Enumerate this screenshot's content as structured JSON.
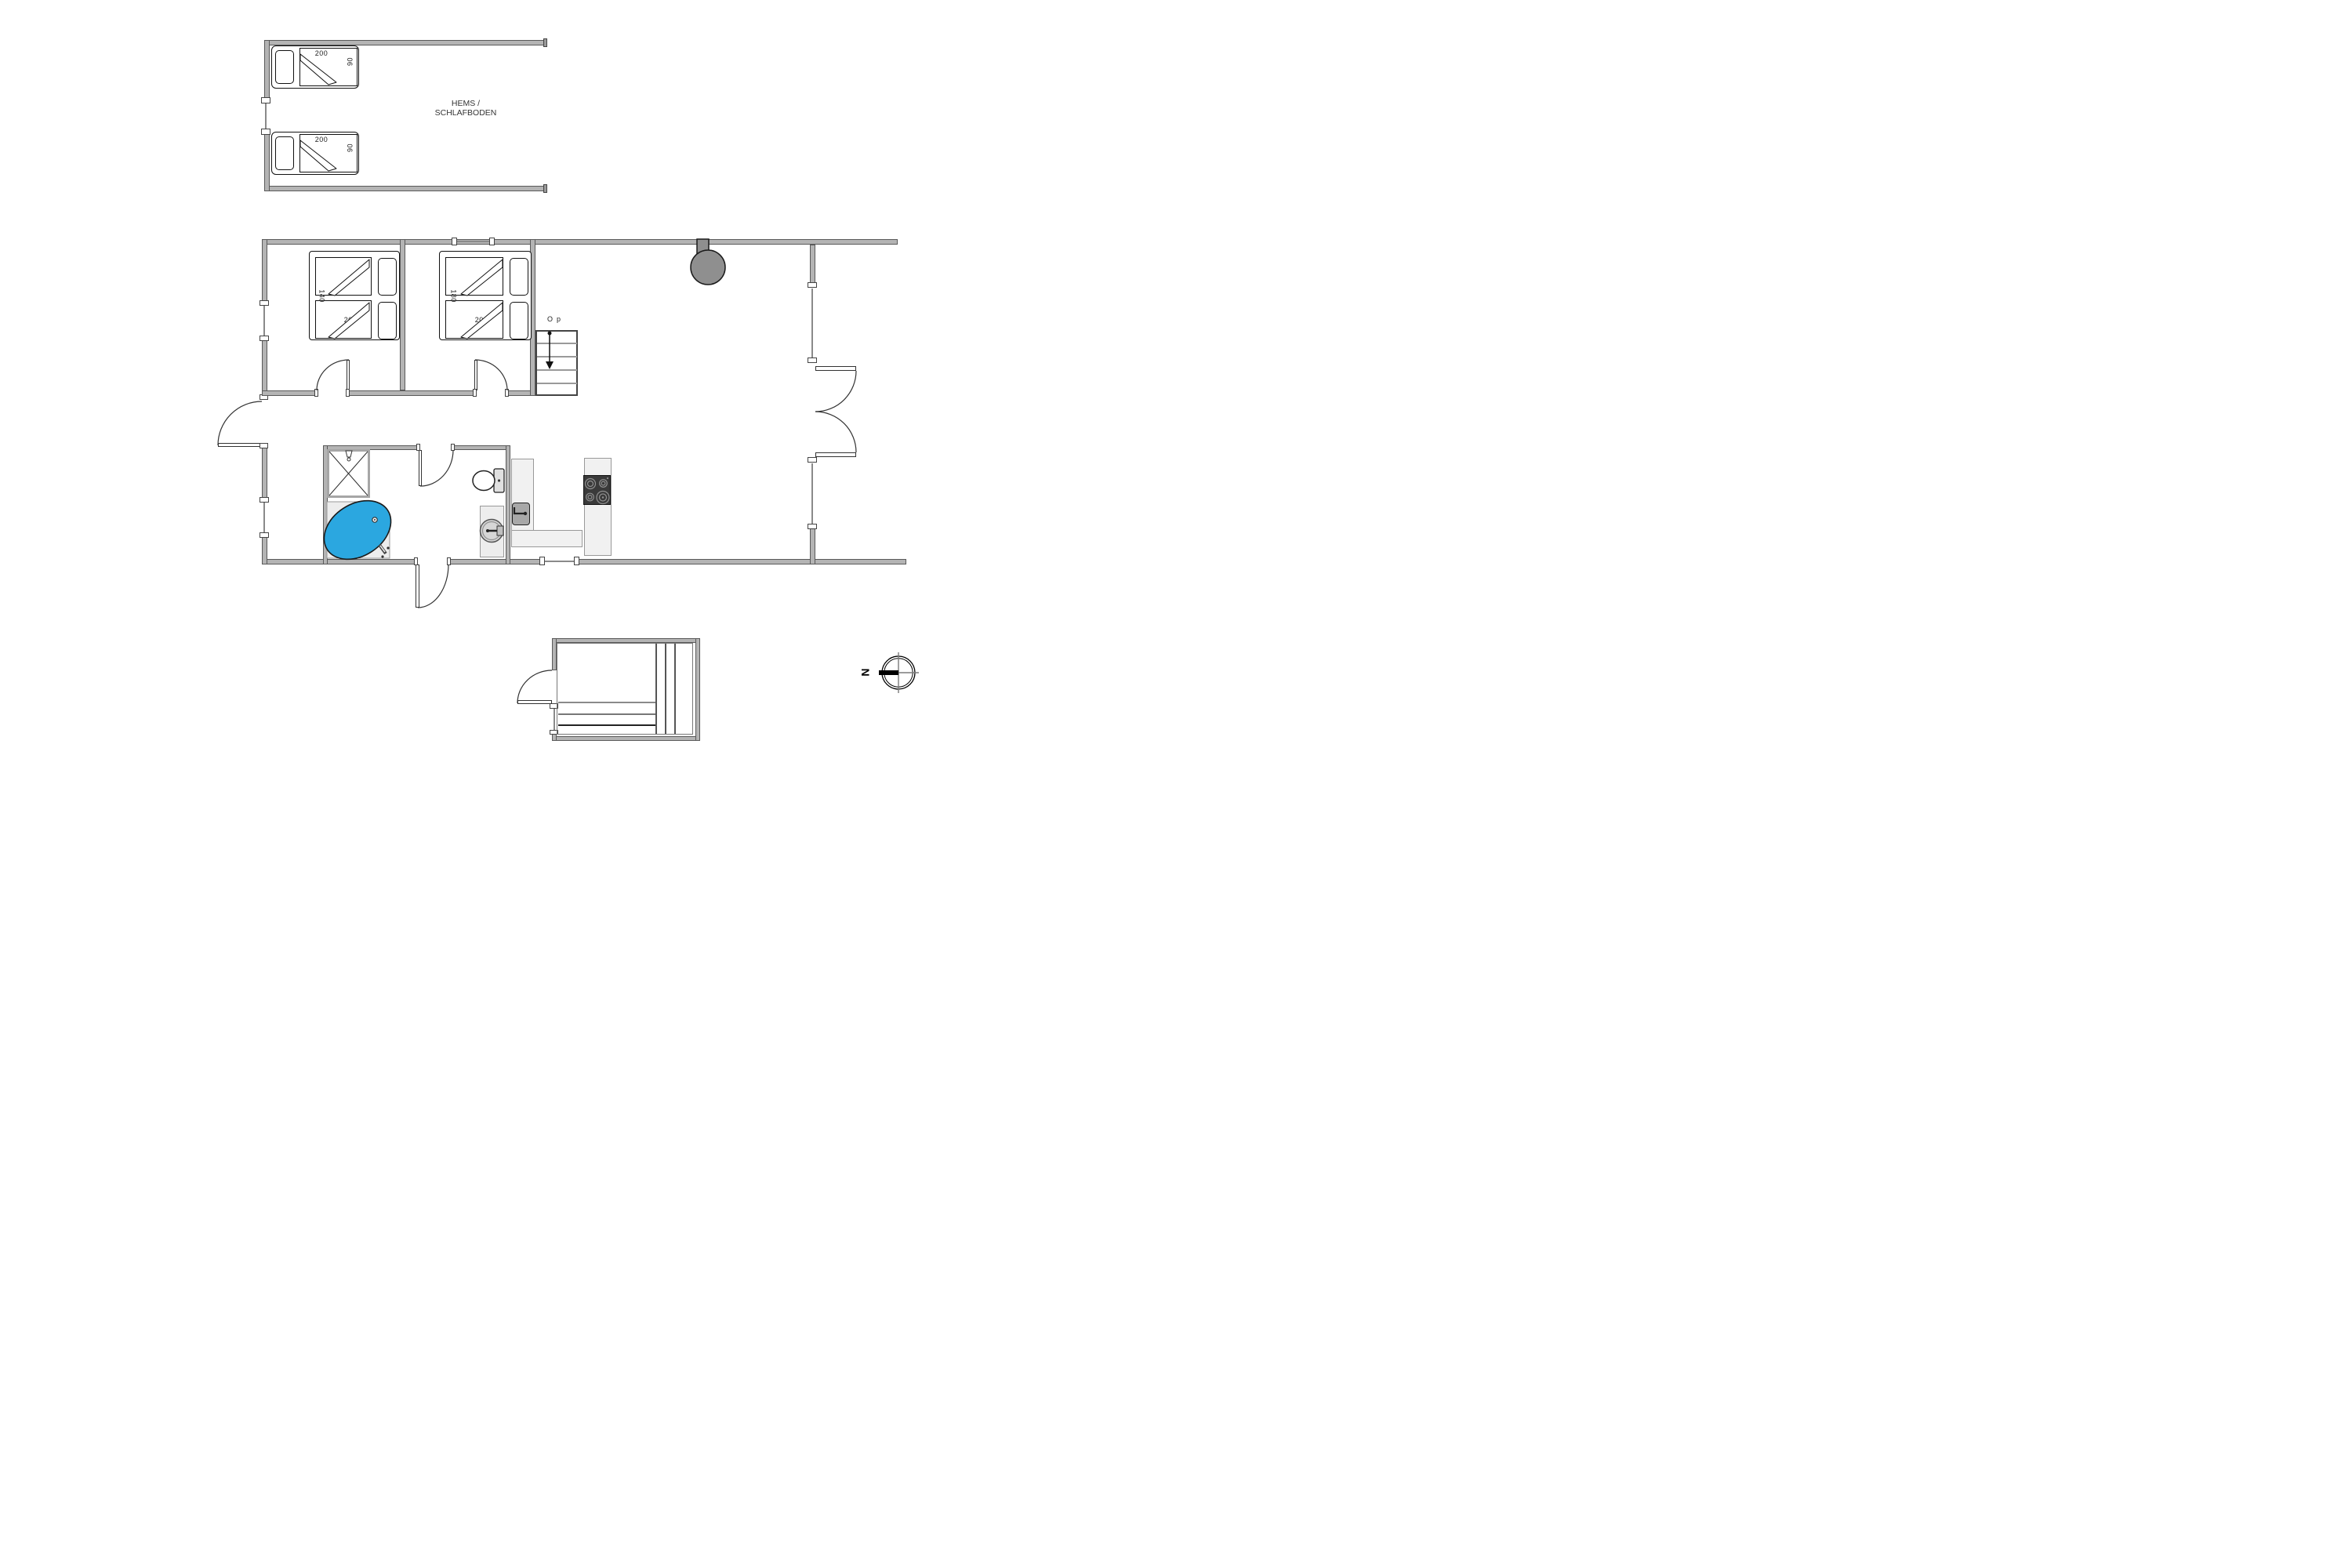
{
  "plan": {
    "loft": {
      "label_line1": "HEMS /",
      "label_line2": "SCHLAFBODEN"
    },
    "stairs": {
      "label": "Op"
    },
    "compass": {
      "north_label": "N"
    },
    "beds": {
      "loft_top": {
        "length": "200",
        "width": "90"
      },
      "loft_bottom": {
        "length": "200",
        "width": "90"
      },
      "bedroom1": {
        "width": "140",
        "length": "200"
      },
      "bedroom2": {
        "width": "180",
        "length": "200"
      }
    },
    "colors": {
      "wall": "#b4b4b4",
      "tub": "#2ba7e0",
      "cooktop": "#3a3a3a",
      "stove": "#8f8f8f"
    }
  }
}
